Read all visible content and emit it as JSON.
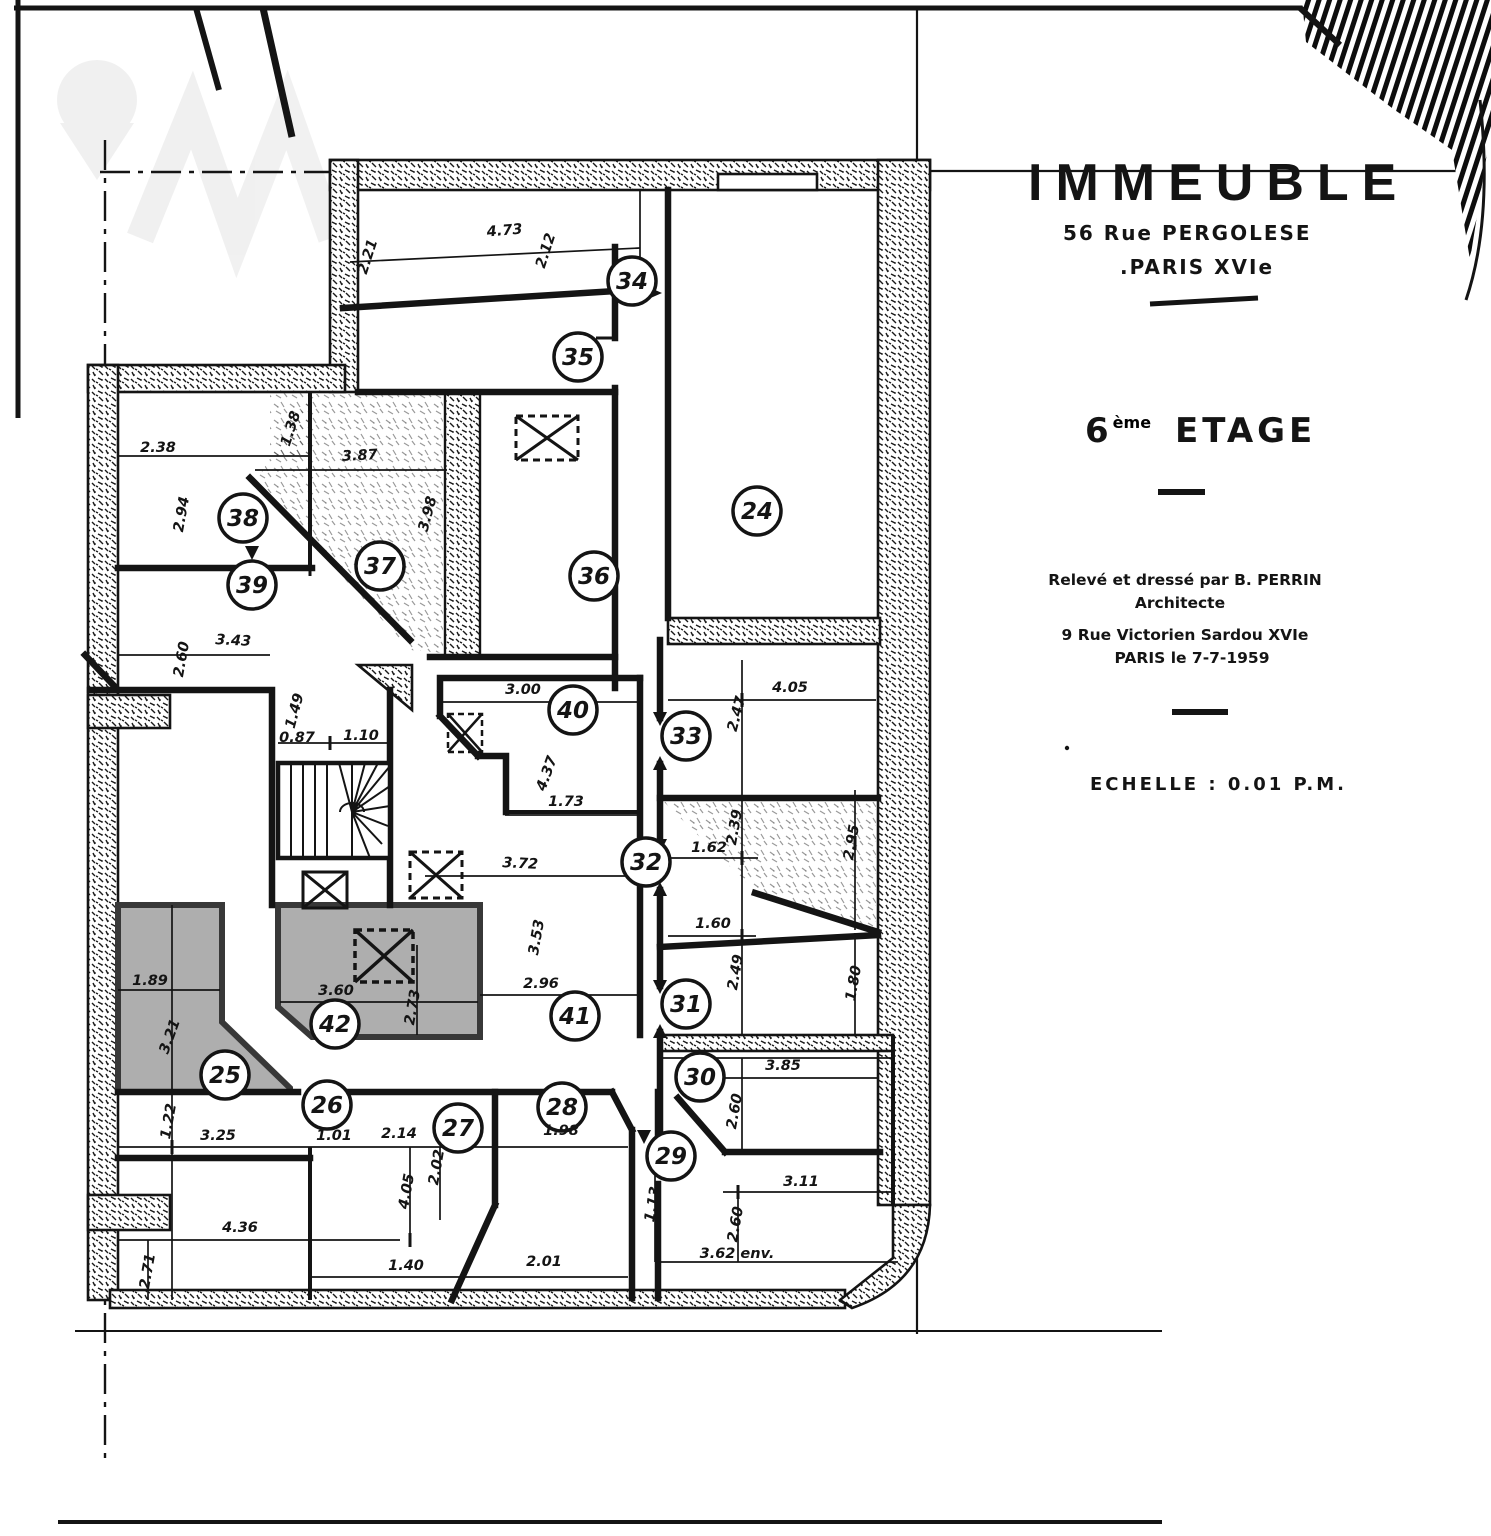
{
  "doc": {
    "title": "IMMEUBLE",
    "address1": "56 Rue PERGOLESE",
    "address2": ".PARIS XVIe"
  },
  "floor": {
    "number": "6",
    "suffix": "ème",
    "word": "ETAGE"
  },
  "credits": {
    "line1": "Relevé et dressé par B. PERRIN",
    "line2": "Architecte",
    "line3": "9 Rue Victorien Sardou XVIe",
    "line4": "PARIS le 7-7-1959"
  },
  "scale": {
    "label": "ECHELLE : 0.01 P.M."
  },
  "colors": {
    "ink": "#141414",
    "paper": "#ffffff",
    "shade": "#aeaeae",
    "shade_stroke": "#383838"
  },
  "rooms": [
    {
      "n": "24",
      "x": 757,
      "y": 511
    },
    {
      "n": "25",
      "x": 225,
      "y": 1075
    },
    {
      "n": "26",
      "x": 327,
      "y": 1105
    },
    {
      "n": "27",
      "x": 458,
      "y": 1128
    },
    {
      "n": "28",
      "x": 562,
      "y": 1107
    },
    {
      "n": "29",
      "x": 671,
      "y": 1156
    },
    {
      "n": "30",
      "x": 700,
      "y": 1077
    },
    {
      "n": "31",
      "x": 686,
      "y": 1004
    },
    {
      "n": "32",
      "x": 646,
      "y": 862
    },
    {
      "n": "33",
      "x": 686,
      "y": 736
    },
    {
      "n": "34",
      "x": 632,
      "y": 281
    },
    {
      "n": "35",
      "x": 578,
      "y": 357
    },
    {
      "n": "36",
      "x": 594,
      "y": 576
    },
    {
      "n": "37",
      "x": 380,
      "y": 566
    },
    {
      "n": "38",
      "x": 243,
      "y": 518
    },
    {
      "n": "39",
      "x": 252,
      "y": 585
    },
    {
      "n": "40",
      "x": 573,
      "y": 710
    },
    {
      "n": "41",
      "x": 575,
      "y": 1016
    },
    {
      "n": "42",
      "x": 335,
      "y": 1024
    }
  ],
  "dims": [
    {
      "t": "4.73",
      "x": 505,
      "y": 235,
      "r": -5
    },
    {
      "t": "2.21",
      "x": 372,
      "y": 258,
      "r": -72
    },
    {
      "t": "2.12",
      "x": 550,
      "y": 252,
      "r": -72
    },
    {
      "t": "2.38",
      "x": 158,
      "y": 452,
      "r": 0
    },
    {
      "t": "1.38",
      "x": 295,
      "y": 430,
      "r": -72
    },
    {
      "t": "3.87",
      "x": 360,
      "y": 460,
      "r": -3
    },
    {
      "t": "3.98",
      "x": 432,
      "y": 515,
      "r": -75
    },
    {
      "t": "2.94",
      "x": 186,
      "y": 515,
      "r": -80
    },
    {
      "t": "2.60",
      "x": 186,
      "y": 660,
      "r": -80
    },
    {
      "t": "3.43",
      "x": 233,
      "y": 645,
      "r": 3
    },
    {
      "t": "1.49",
      "x": 299,
      "y": 712,
      "r": -75
    },
    {
      "t": "0.87",
      "x": 297,
      "y": 742,
      "r": 0
    },
    {
      "t": "1.10",
      "x": 361,
      "y": 740,
      "r": 0
    },
    {
      "t": "3.00",
      "x": 523,
      "y": 694,
      "r": 0
    },
    {
      "t": "4.37",
      "x": 551,
      "y": 775,
      "r": -70
    },
    {
      "t": "1.73",
      "x": 566,
      "y": 806,
      "r": 0
    },
    {
      "t": "3.72",
      "x": 520,
      "y": 868,
      "r": 3
    },
    {
      "t": "3.53",
      "x": 541,
      "y": 938,
      "r": -80
    },
    {
      "t": "2.96",
      "x": 541,
      "y": 988,
      "r": 0
    },
    {
      "t": "4.05",
      "x": 790,
      "y": 692,
      "r": 0
    },
    {
      "t": "2.47",
      "x": 741,
      "y": 715,
      "r": -75
    },
    {
      "t": "2.39",
      "x": 739,
      "y": 828,
      "r": -80
    },
    {
      "t": "1.62",
      "x": 709,
      "y": 852,
      "r": 0
    },
    {
      "t": "2.95",
      "x": 856,
      "y": 843,
      "r": -80
    },
    {
      "t": "1.60",
      "x": 713,
      "y": 928,
      "r": 0
    },
    {
      "t": "2.49",
      "x": 740,
      "y": 973,
      "r": -80
    },
    {
      "t": "1.80",
      "x": 858,
      "y": 984,
      "r": -80
    },
    {
      "t": "3.85",
      "x": 783,
      "y": 1070,
      "r": 0
    },
    {
      "t": "2.60",
      "x": 739,
      "y": 1112,
      "r": -80
    },
    {
      "t": "3.11",
      "x": 801,
      "y": 1186,
      "r": 0
    },
    {
      "t": "1.13",
      "x": 657,
      "y": 1205,
      "r": -80
    },
    {
      "t": "2.60",
      "x": 740,
      "y": 1225,
      "r": -80
    },
    {
      "t": "3.62 env.",
      "x": 737,
      "y": 1258,
      "r": 0
    },
    {
      "t": "1.89",
      "x": 150,
      "y": 985,
      "r": 0
    },
    {
      "t": "3.21",
      "x": 174,
      "y": 1038,
      "r": -70
    },
    {
      "t": "3.60",
      "x": 336,
      "y": 995,
      "r": 0
    },
    {
      "t": "2.73",
      "x": 417,
      "y": 1008,
      "r": -80
    },
    {
      "t": "1.22",
      "x": 173,
      "y": 1122,
      "r": -80
    },
    {
      "t": "3.25",
      "x": 218,
      "y": 1140,
      "r": 0
    },
    {
      "t": "1.01",
      "x": 334,
      "y": 1140,
      "r": 0
    },
    {
      "t": "2.14",
      "x": 399,
      "y": 1138,
      "r": 0
    },
    {
      "t": "4.05",
      "x": 411,
      "y": 1192,
      "r": -80
    },
    {
      "t": "2.02",
      "x": 441,
      "y": 1168,
      "r": -80
    },
    {
      "t": "1.98",
      "x": 561,
      "y": 1135,
      "r": 0
    },
    {
      "t": "1.40",
      "x": 406,
      "y": 1270,
      "r": 0
    },
    {
      "t": "2.01",
      "x": 544,
      "y": 1266,
      "r": 0
    },
    {
      "t": "4.36",
      "x": 240,
      "y": 1232,
      "r": 0
    },
    {
      "t": "2.71",
      "x": 152,
      "y": 1272,
      "r": -80
    }
  ]
}
